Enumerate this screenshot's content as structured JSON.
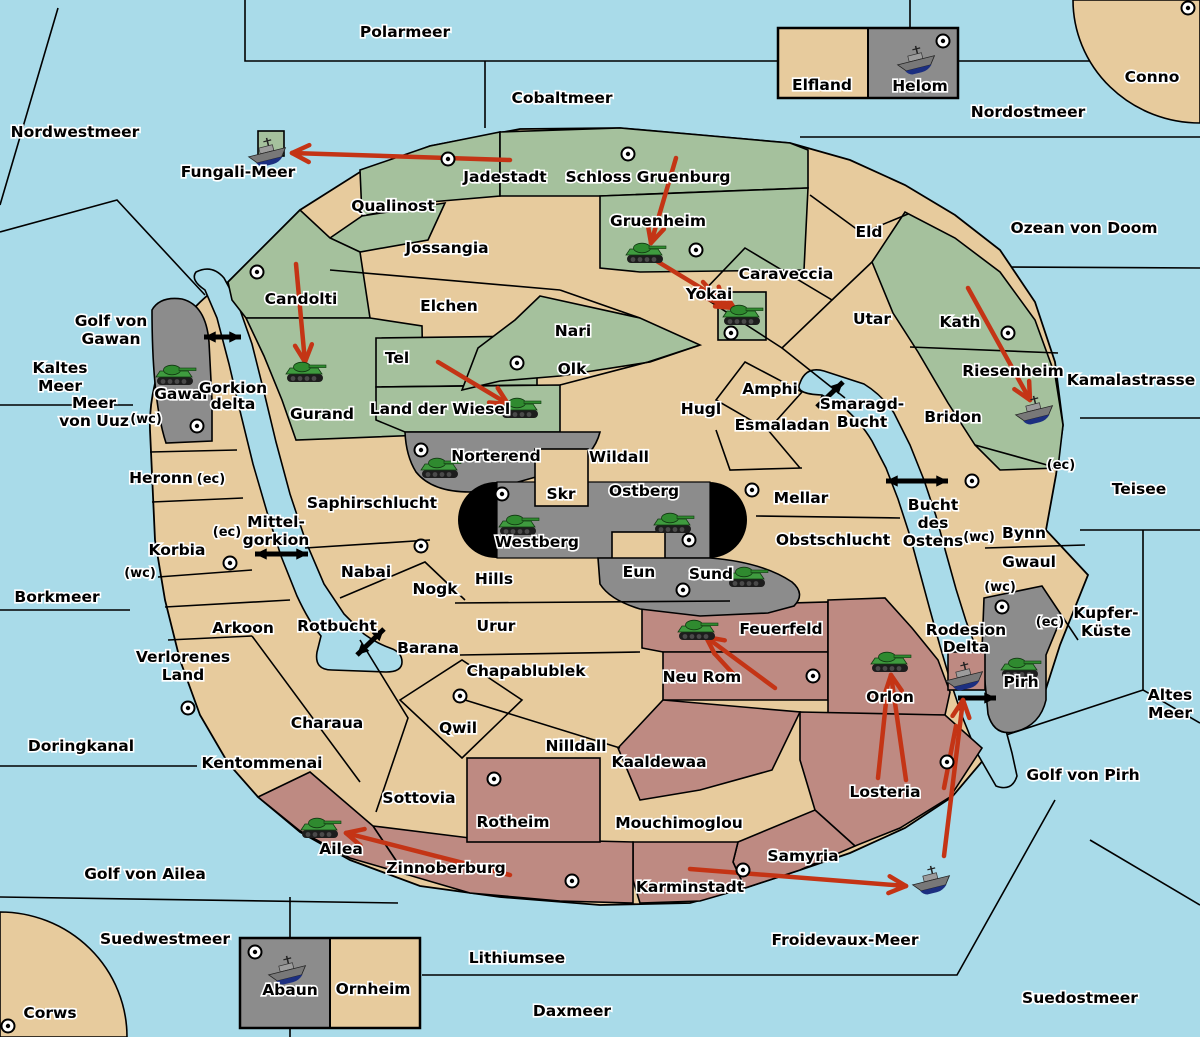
{
  "map": {
    "colors": {
      "sea": "#A9DBE9",
      "land_tan": "#E7CB9D",
      "land_green": "#A5C19D",
      "land_gray": "#8C8C8C",
      "land_red": "#BE8A82",
      "capsule_black": "#000000",
      "attack_arrow_red": "#C43415",
      "link_arrow_black": "#000000"
    },
    "labels": [
      [
        "Polarmeer",
        405,
        37
      ],
      [
        "Nordwestmeer",
        75,
        137
      ],
      [
        "Cobaltmeer",
        562,
        103
      ],
      [
        "Nordostmeer",
        1028,
        117
      ],
      [
        "Conno",
        1152,
        82
      ],
      [
        "Ozean von Doom",
        1084,
        233
      ],
      [
        "Kamalastrasse",
        1131,
        385
      ],
      [
        "Teisee",
        1139,
        494
      ],
      [
        "Kupfer-",
        1106,
        618
      ],
      [
        "Küste",
        1106,
        636
      ],
      [
        "Altes",
        1170,
        700
      ],
      [
        "Meer",
        1170,
        718
      ],
      [
        "Golf von Pirh",
        1083,
        780
      ],
      [
        "Froidevaux-Meer",
        845,
        945
      ],
      [
        "Suedostmeer",
        1080,
        1003
      ],
      [
        "Daxmeer",
        572,
        1016
      ],
      [
        "Lithiumsee",
        517,
        963
      ],
      [
        "Suedwestmeer",
        165,
        944
      ],
      [
        "Corws",
        50,
        1018
      ],
      [
        "Golf von Ailea",
        145,
        879
      ],
      [
        "Doringkanal",
        81,
        751
      ],
      [
        "Borkmeer",
        57,
        602
      ],
      [
        "Kaltes",
        60,
        373
      ],
      [
        "Meer",
        60,
        391
      ],
      [
        "Meer",
        94,
        408
      ],
      [
        "von Uuz",
        94,
        426
      ],
      [
        "Golf von",
        111,
        326
      ],
      [
        "Gawan",
        111,
        344
      ],
      [
        "Fungali-Meer",
        238,
        177
      ],
      [
        "Mittel-",
        276,
        527
      ],
      [
        "gorkion",
        276,
        545
      ],
      [
        "Smaragd-",
        862,
        409
      ],
      [
        "Bucht",
        862,
        427
      ],
      [
        "Bucht",
        933,
        510
      ],
      [
        "des",
        933,
        528
      ],
      [
        "Ostens",
        933,
        546
      ],
      [
        "Rotbucht",
        337,
        631
      ],
      [
        "Elfland",
        822,
        90
      ],
      [
        "Helom",
        920,
        91
      ],
      [
        "Eld",
        869,
        237
      ],
      [
        "Utar",
        872,
        324
      ],
      [
        "Caraveccia",
        786,
        279
      ],
      [
        "Jossangia",
        447,
        253
      ],
      [
        "Elchen",
        449,
        311
      ],
      [
        "Nari",
        573,
        336
      ],
      [
        "Olk",
        572,
        374
      ],
      [
        "Hugl",
        701,
        414
      ],
      [
        "Amphi",
        770,
        394
      ],
      [
        "Esmaladan",
        782,
        430
      ],
      [
        "Bridon",
        953,
        422
      ],
      [
        "Mellar",
        801,
        503
      ],
      [
        "Obstschlucht",
        833,
        545
      ],
      [
        "Bynn",
        1024,
        538
      ],
      [
        "Gwaul",
        1029,
        567
      ],
      [
        "Wildall",
        619,
        462
      ],
      [
        "Skr",
        561,
        499
      ],
      [
        "Eun",
        639,
        577
      ],
      [
        "Hills",
        494,
        584
      ],
      [
        "Nogk",
        435,
        594
      ],
      [
        "Nabai",
        366,
        577
      ],
      [
        "Saphirschlucht",
        372,
        508
      ],
      [
        "Urur",
        496,
        631
      ],
      [
        "Barana",
        428,
        653
      ],
      [
        "Chapablublek",
        526,
        676
      ],
      [
        "Qwil",
        458,
        733
      ],
      [
        "Nilldall",
        576,
        751
      ],
      [
        "Heronn",
        161,
        483
      ],
      [
        "Korbia",
        177,
        555
      ],
      [
        "Arkoon",
        243,
        633
      ],
      [
        "Verlorenes",
        183,
        662
      ],
      [
        "Land",
        183,
        680
      ],
      [
        "Kentommenai",
        262,
        768
      ],
      [
        "Charaua",
        327,
        728
      ],
      [
        "Sottovia",
        419,
        803
      ],
      [
        "Mouchimoglou",
        679,
        828
      ],
      [
        "Ornheim",
        373,
        994
      ],
      [
        "Jadestadt",
        505,
        182
      ],
      [
        "Schloss Gruenburg",
        648,
        182
      ],
      [
        "Qualinost",
        393,
        211
      ],
      [
        "Candolti",
        301,
        304
      ],
      [
        "Gurand",
        322,
        419
      ],
      [
        "Tel",
        397,
        363
      ],
      [
        "Land der Wiesel",
        440,
        414
      ],
      [
        "Gruenheim",
        658,
        226
      ],
      [
        "Yokai",
        709,
        299
      ],
      [
        "Kath",
        960,
        327
      ],
      [
        "Riesenheim",
        1013,
        376
      ],
      [
        "Gawar",
        182,
        399
      ],
      [
        "Gorkion",
        233,
        393
      ],
      [
        "delta",
        233,
        409
      ],
      [
        "Norterend",
        496,
        461
      ],
      [
        "Westberg",
        537,
        547
      ],
      [
        "Ostberg",
        644,
        496
      ],
      [
        "Sund",
        711,
        579
      ],
      [
        "Pirh",
        1021,
        687
      ],
      [
        "Abaun",
        290,
        995
      ],
      [
        "Feuerfeld",
        781,
        634
      ],
      [
        "Neu Rom",
        702,
        682
      ],
      [
        "Kaaldewaa",
        659,
        767
      ],
      [
        "Rotheim",
        513,
        827
      ],
      [
        "Zinnoberburg",
        446,
        873
      ],
      [
        "Karminstadt",
        690,
        892
      ],
      [
        "Samyria",
        803,
        861
      ],
      [
        "Losteria",
        885,
        797
      ],
      [
        "Orlon",
        890,
        702
      ],
      [
        "Ailea",
        341,
        854
      ],
      [
        "Rodesion",
        966,
        635
      ],
      [
        "Delta",
        966,
        652
      ],
      [
        "(wc)",
        146,
        423,
        13
      ],
      [
        "(ec)",
        211,
        483,
        13
      ],
      [
        "(ec)",
        227,
        536,
        13
      ],
      [
        "(wc)",
        140,
        577,
        13
      ],
      [
        "(ec)",
        1061,
        469,
        13
      ],
      [
        "(wc)",
        979,
        541,
        13
      ],
      [
        "(wc)",
        1000,
        591,
        13
      ],
      [
        "(ec)",
        1050,
        626,
        13
      ]
    ],
    "city_dots": [
      [
        448,
        159
      ],
      [
        628,
        154
      ],
      [
        696,
        250
      ],
      [
        257,
        272
      ],
      [
        943,
        41
      ],
      [
        1188,
        8
      ],
      [
        517,
        363
      ],
      [
        731,
        333
      ],
      [
        1008,
        333
      ],
      [
        972,
        481
      ],
      [
        197,
        426
      ],
      [
        421,
        450
      ],
      [
        502,
        494
      ],
      [
        752,
        490
      ],
      [
        689,
        540
      ],
      [
        683,
        590
      ],
      [
        421,
        546
      ],
      [
        230,
        563
      ],
      [
        188,
        708
      ],
      [
        460,
        696
      ],
      [
        494,
        779
      ],
      [
        813,
        676
      ],
      [
        947,
        762
      ],
      [
        572,
        881
      ],
      [
        743,
        870
      ],
      [
        255,
        952
      ],
      [
        8,
        1026
      ],
      [
        1002,
        607
      ]
    ],
    "units": {
      "tanks": [
        [
          175,
          375
        ],
        [
          305,
          372
        ],
        [
          520,
          408
        ],
        [
          645,
          253
        ],
        [
          742,
          315
        ],
        [
          440,
          468
        ],
        [
          518,
          525
        ],
        [
          673,
          523
        ],
        [
          747,
          577
        ],
        [
          697,
          630
        ],
        [
          890,
          662
        ],
        [
          1020,
          668
        ],
        [
          320,
          828
        ]
      ],
      "ships": [
        [
          268,
          152
        ],
        [
          917,
          60
        ],
        [
          1035,
          410
        ],
        [
          965,
          676
        ],
        [
          932,
          880
        ],
        [
          288,
          970
        ]
      ]
    },
    "red_arrows": [
      [
        510,
        160,
        292,
        153
      ],
      [
        676,
        158,
        651,
        243
      ],
      [
        655,
        260,
        734,
        308
      ],
      [
        296,
        264,
        305,
        362
      ],
      [
        438,
        362,
        508,
        404
      ],
      [
        968,
        288,
        1030,
        400
      ],
      [
        775,
        688,
        706,
        637
      ],
      [
        906,
        780,
        891,
        675
      ],
      [
        944,
        856,
        963,
        700
      ],
      [
        690,
        869,
        906,
        886
      ],
      [
        510,
        875,
        346,
        833
      ],
      [
        703,
        282,
        724,
        305
      ]
    ],
    "red_lines": [
      [
        878,
        778,
        886,
        702
      ],
      [
        944,
        788,
        956,
        726
      ],
      [
        737,
        678,
        714,
        653
      ]
    ],
    "black_arrows": [
      {
        "x1": 204,
        "y1": 337,
        "x2": 241,
        "y2": 337,
        "double": true
      },
      {
        "x1": 255,
        "y1": 554,
        "x2": 308,
        "y2": 554,
        "double": true
      },
      {
        "x1": 357,
        "y1": 655,
        "x2": 384,
        "y2": 629,
        "double": true
      },
      {
        "x1": 817,
        "y1": 407,
        "x2": 843,
        "y2": 382,
        "double": true
      },
      {
        "x1": 886,
        "y1": 481,
        "x2": 948,
        "y2": 481,
        "double": true
      },
      {
        "x1": 958,
        "y1": 698,
        "x2": 996,
        "y2": 698,
        "double": false
      }
    ]
  }
}
